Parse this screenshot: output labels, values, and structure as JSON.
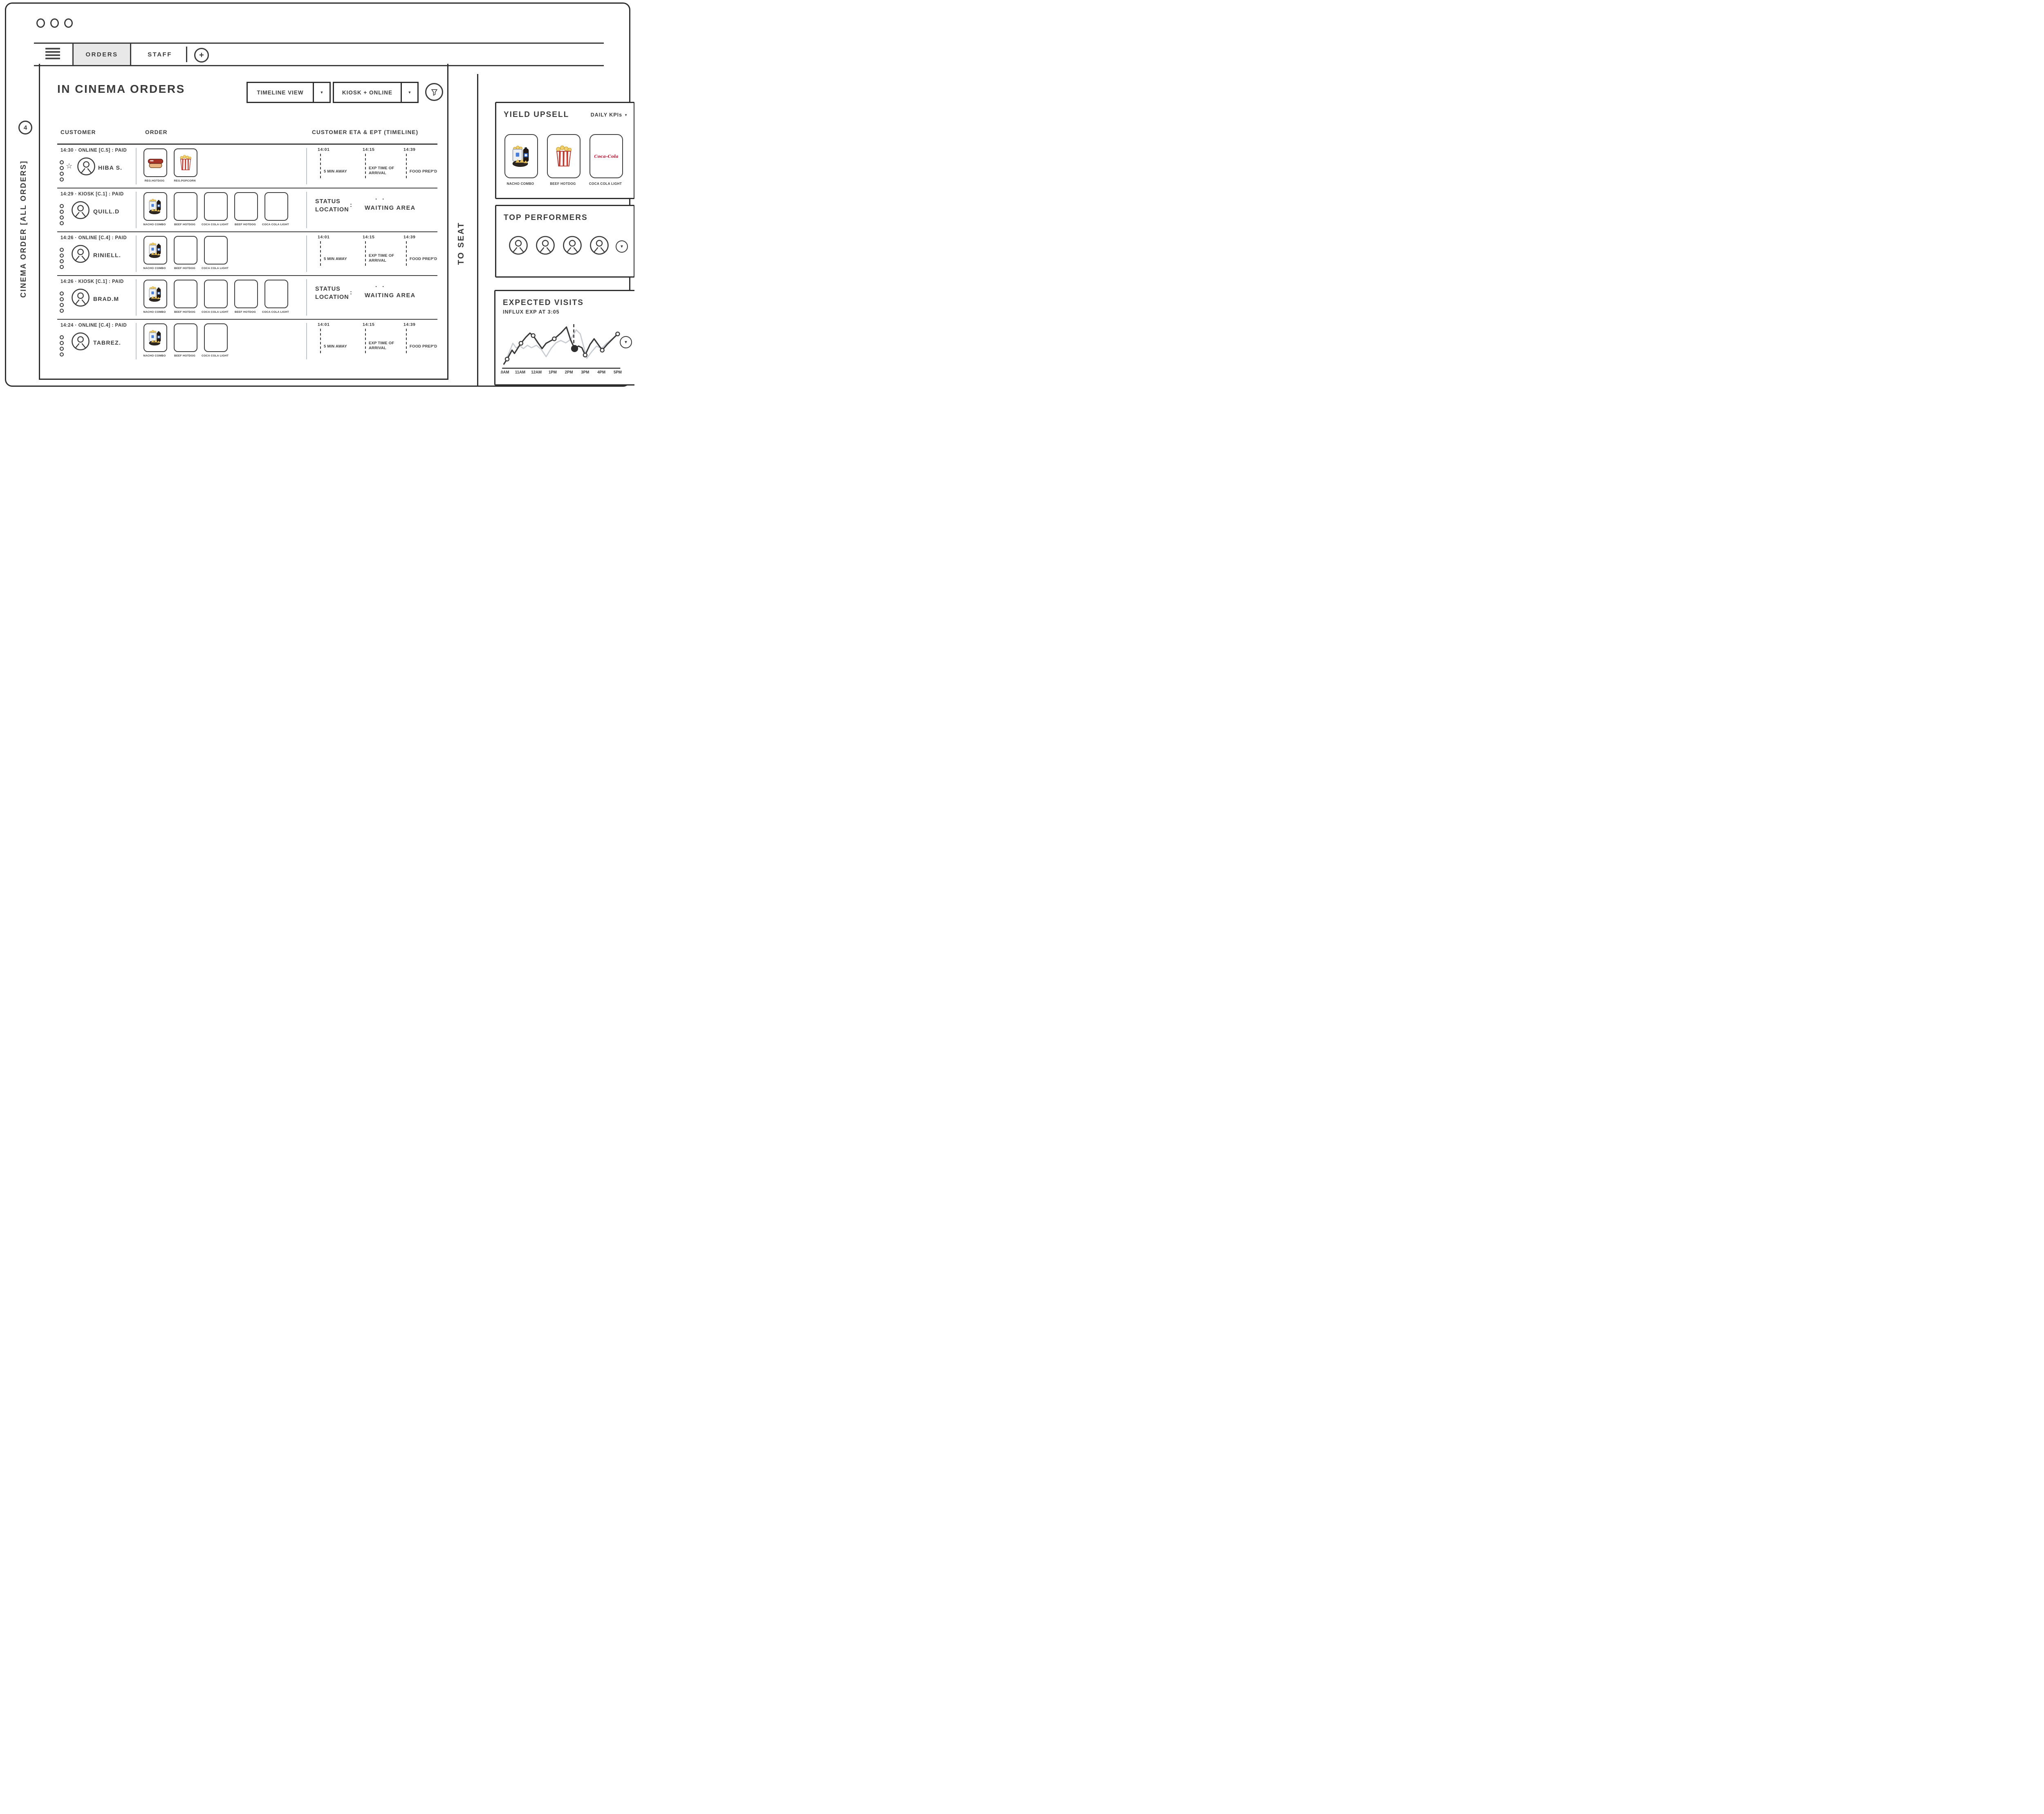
{
  "icons": {
    "caret_down": "▼",
    "star": "☆",
    "plus": "+",
    "status_accent": "· ·"
  },
  "topbar": {
    "tabs": [
      {
        "label": "ORDERS",
        "active": true
      },
      {
        "label": "STAFF",
        "active": false
      }
    ]
  },
  "left_rail": {
    "badge_count": "4",
    "vertical_label": "CINEMA ORDER [ALL ORDERS]"
  },
  "main": {
    "title": "IN CINEMA ORDERS",
    "view_dropdown": "TIMELINE VIEW",
    "source_dropdown": "KIOSK + ONLINE",
    "columns": {
      "customer": "CUSTOMER",
      "order": "ORDER",
      "timeline": "CUSTOMER ETA & EPT (TIMELINE)"
    },
    "timeline_milestones": [
      {
        "time": "14:01",
        "label": "5 MIN AWAY"
      },
      {
        "time": "14:15",
        "label": "EXP TIME OF ARRIVAL"
      },
      {
        "time": "14:39",
        "label": "FOOD PREP'D"
      }
    ],
    "status_label_line1": "STATUS",
    "status_label_line2": "LOCATION",
    "status_colon": ":",
    "rows": [
      {
        "meta": "14:30 · ONLINE [C.5] : PAID",
        "name": "HIBA S.",
        "right": "timeline",
        "items": [
          {
            "label": "REG.HOTDOG",
            "icon": "hotdog"
          },
          {
            "label": "REG.POPCORN",
            "icon": "popcorn-box"
          }
        ]
      },
      {
        "meta": "14:29 · KIOSK [C.1] : PAID",
        "name": "QUILL.D",
        "right": "status",
        "status_value": "WAITING AREA",
        "items": [
          {
            "label": "NACHO COMBO",
            "icon": "nacho-combo"
          },
          {
            "label": "BEEF HOTDOG",
            "icon": "empty"
          },
          {
            "label": "COCA COLA LIGHT",
            "icon": "empty"
          },
          {
            "label": "BEEF HOTDOG",
            "icon": "empty"
          },
          {
            "label": "COCA COLA LIGHT",
            "icon": "empty"
          }
        ]
      },
      {
        "meta": "14:26 · ONLINE [C.4] : PAID",
        "name": "RINIELL.",
        "right": "timeline",
        "items": [
          {
            "label": "NACHO COMBO",
            "icon": "nacho-combo"
          },
          {
            "label": "BEEF HOTDOG",
            "icon": "empty"
          },
          {
            "label": "COCA COLA LIGHT",
            "icon": "empty"
          }
        ]
      },
      {
        "meta": "14:26 · KIOSK [C.1] : PAID",
        "name": "BRAD.M",
        "right": "status",
        "status_value": "WAITING AREA",
        "items": [
          {
            "label": "NACHO COMBO",
            "icon": "nacho-combo"
          },
          {
            "label": "BEEF HOTDOG",
            "icon": "empty"
          },
          {
            "label": "COCA COLA LIGHT",
            "icon": "empty"
          },
          {
            "label": "BEEF HOTDOG",
            "icon": "empty"
          },
          {
            "label": "COCA COLA LIGHT",
            "icon": "empty"
          }
        ]
      },
      {
        "meta": "14:24 · ONLINE [C.4] : PAID",
        "name": "TABREZ.",
        "right": "timeline",
        "items": [
          {
            "label": "NACHO COMBO",
            "icon": "nacho-combo"
          },
          {
            "label": "BEEF HOTDOG",
            "icon": "empty"
          },
          {
            "label": "COCA COLA LIGHT",
            "icon": "empty"
          }
        ]
      }
    ]
  },
  "to_seat_label": "TO SEAT",
  "panels": {
    "yield_upsell": {
      "title": "YIELD UPSELL",
      "kpi_dropdown": "DAILY KPIs",
      "items": [
        {
          "label": "NACHO COMBO",
          "icon": "nacho-combo"
        },
        {
          "label": "BEEF HOTDOG",
          "icon": "popcorn-box"
        },
        {
          "label": "COCA COLA LIGHT",
          "icon": "coca-cola",
          "logo_text": "Coca-Cola"
        }
      ]
    },
    "top_performers": {
      "title": "TOP PERFORMERS"
    },
    "expected_visits": {
      "title": "EXPECTED VISITS",
      "subtitle": "INFLUX EXP AT 3:05"
    }
  },
  "chart_data": {
    "type": "line",
    "title": "EXPECTED VISITS",
    "subtitle": "INFLUX EXP AT 3:05",
    "categories": [
      "10AM",
      "11AM",
      "12AM",
      "1PM",
      "2PM",
      "3PM",
      "4PM",
      "5PM"
    ],
    "x_range": [
      10,
      17
    ],
    "ylim": [
      0,
      100
    ],
    "grid": false,
    "legend": "none",
    "annotation": {
      "label": "INFLUX EXP AT 3:05",
      "x": 14.3
    },
    "series": [
      {
        "name": "expected-visits",
        "color": "#3a3a3a",
        "x": [
          10.0,
          10.2,
          10.5,
          10.65,
          10.9,
          11.05,
          11.35,
          11.6,
          11.8,
          12.1,
          12.35,
          12.6,
          13.1,
          13.5,
          13.85,
          14.1,
          14.35,
          14.6,
          14.8,
          15.0,
          15.3,
          15.55,
          15.8,
          16.05,
          16.35,
          16.7,
          17.0
        ],
        "values": [
          4,
          16,
          38,
          30,
          46,
          55,
          70,
          80,
          74,
          56,
          42,
          55,
          66,
          80,
          95,
          64,
          42,
          48,
          44,
          26,
          52,
          66,
          52,
          38,
          52,
          66,
          78
        ],
        "marker_indices": [
          1,
          5,
          8,
          12,
          19,
          23,
          26
        ],
        "highlight_index": 16
      },
      {
        "name": "baseline",
        "color": "#c9cdd2",
        "x": [
          10.0,
          10.3,
          10.55,
          10.75,
          11.0,
          11.2,
          11.45,
          11.7,
          12.0,
          12.3,
          12.6,
          12.9,
          13.2,
          13.5,
          13.8,
          14.1,
          14.45,
          14.7,
          14.9,
          15.1,
          15.4,
          15.7,
          16.0,
          16.3,
          16.6,
          17.0
        ],
        "values": [
          2,
          30,
          55,
          44,
          48,
          42,
          50,
          44,
          50,
          40,
          22,
          42,
          56,
          62,
          56,
          64,
          88,
          78,
          48,
          18,
          34,
          48,
          42,
          54,
          64,
          76
        ]
      }
    ]
  }
}
